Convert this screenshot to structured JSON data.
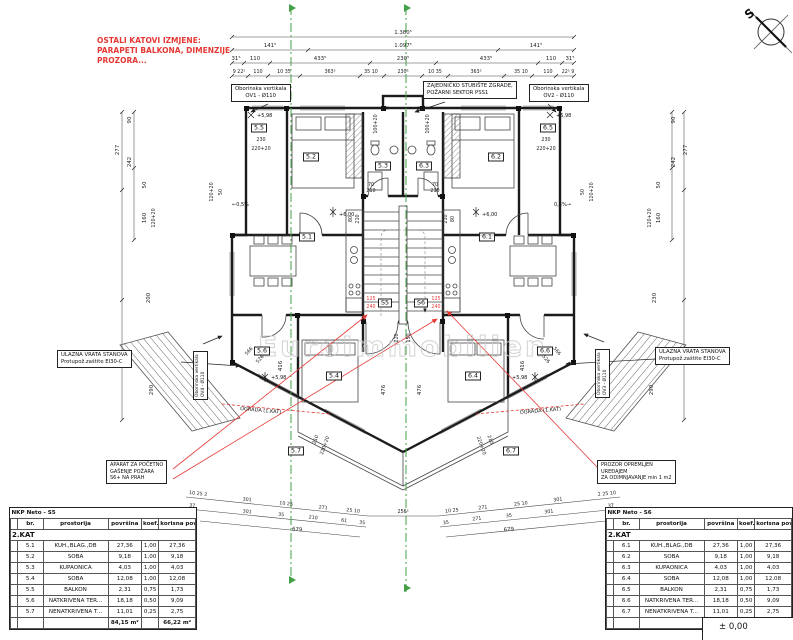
{
  "colors": {
    "wall": "#1b1b1b",
    "accent_red": "#e53935",
    "section_green": "#43a047",
    "dim_text": "#222222",
    "watermark_gray": "#c9c9c9"
  },
  "compass": {
    "label": "S"
  },
  "watermark": "EuroImmobilien",
  "notes": {
    "revision": [
      "OSTALI KATOVI IZMJENE:",
      "PARAPETI BALKONA, DIMENZIJE",
      "PROZORA..."
    ],
    "railing": "OGRADA (1.KAT)"
  },
  "callouts": {
    "ov1": [
      "Oborinska vertikala",
      "OV1 - Ø110"
    ],
    "ov2": [
      "Oborinska vertikala",
      "OV2 - Ø110"
    ],
    "ov3": [
      "Oborinska vertikala",
      "OV3 - Ø110"
    ],
    "ov4": [
      "Oborinska vertikala",
      "OV4 - Ø110"
    ],
    "stairwell": [
      "ZAJEDNIČKO STUBIŠTE ZGRADE,",
      "POŽARNI SEKTOR PSS1"
    ],
    "entry": [
      "ULAZNA VRATA STANOVA",
      "Protupož.zaštite EI30-C"
    ],
    "extinguisher": [
      "APARAT ZA POČETNO",
      "GAŠENJE POŽARA",
      "S6+ NA PRAH"
    ],
    "smoke_window": [
      "PROZOR OPREMLJEN",
      "UREĐAJEM",
      "ZA ODIMNJAVANJE min 1 m2"
    ]
  },
  "rooms": {
    "r51": "5.1",
    "r52": "5.2",
    "r53": "5.3",
    "r54": "5.4",
    "r55": "5.5",
    "r56": "5.6",
    "r57": "5.7",
    "r61": "6.1",
    "r62": "6.2",
    "r63": "6.3",
    "r64": "6.4",
    "r65": "6.5",
    "r66": "6.6",
    "r67": "6.7",
    "s5": "S5",
    "s6": "S6"
  },
  "levels": {
    "upper": "+6,00",
    "balcony": "+5,98",
    "ground": "± 0,00",
    "slope_left": "←0,5%",
    "slope_right": "0,5%→"
  },
  "dims": {
    "top1": [
      "1.380⁵"
    ],
    "top2": [
      "141⁵",
      "1.097⁵",
      "141⁵"
    ],
    "top3": [
      "31⁵",
      "110",
      "433⁵",
      "230⁵",
      "433⁵",
      "110",
      "31⁵"
    ],
    "top4": [
      "9 22⁵",
      "110",
      "10 35",
      "363⁵",
      "35 10",
      "230⁵",
      "10 35",
      "363⁵",
      "35 10",
      "110",
      "22⁵ 9"
    ],
    "left": [
      "277",
      "242",
      "90",
      "160",
      "120+20",
      "50",
      "200",
      "290"
    ],
    "right": [
      "277",
      "242",
      "90",
      "160",
      "120+20",
      "50",
      "230",
      "290"
    ],
    "side_inner": [
      "50",
      "120+20",
      "50",
      "120+20"
    ],
    "balcony_left": [
      "230",
      "220+20"
    ],
    "balcony_right": [
      "230",
      "220+20"
    ],
    "door_top": [
      "100+20",
      "100+20",
      "70",
      "210",
      "70",
      "210"
    ],
    "door_52": [
      "80",
      "210"
    ],
    "door_62": [
      "80",
      "210"
    ],
    "lower": [
      "416",
      "476",
      "476",
      "416",
      "210",
      "220+20",
      "210",
      "220+20",
      "220",
      "150"
    ],
    "diag_left": [
      "566",
      "526"
    ],
    "diag_right": [
      "566",
      "526"
    ],
    "bottomA_left": [
      "10 25 2",
      "301",
      "10 25",
      "271",
      "25 10"
    ],
    "bottomA_center": [
      "256⁵"
    ],
    "bottomA_right": [
      "10 25",
      "271",
      "25 10",
      "301",
      "2 25 10"
    ],
    "bottomB_left": [
      "37",
      "301",
      "35",
      "210",
      "61",
      "35"
    ],
    "bottomB_right": [
      "35",
      "271",
      "35",
      "301",
      "37"
    ],
    "bottomC": [
      "679",
      "679"
    ],
    "door_red_left": [
      "125",
      "240"
    ],
    "door_red_right": [
      "125",
      "240"
    ]
  },
  "tables": {
    "left": {
      "title": "NKP Neto - S5",
      "floor": "2.KAT",
      "columns": [
        "",
        "br.",
        "prostorija",
        "površina",
        "koef.",
        "korisna povr..."
      ],
      "rows": [
        [
          "",
          "5.1",
          "KUH.,BLAG.,DB",
          "27,36",
          "1,00",
          "27,36"
        ],
        [
          "",
          "5.2",
          "SOBA",
          "9,18",
          "1,00",
          "9,18"
        ],
        [
          "",
          "5.3",
          "KUPAONICA",
          "4,03",
          "1,00",
          "4,03"
        ],
        [
          "",
          "5.4",
          "SOBA",
          "12,08",
          "1,00",
          "12,08"
        ],
        [
          "",
          "5.5",
          "BALKON",
          "2,31",
          "0,75",
          "1,73"
        ],
        [
          "",
          "5.6",
          "NATKRIVENA TER...",
          "18,18",
          "0,50",
          "9,09"
        ],
        [
          "",
          "5.7",
          "NENATKRIVENA T...",
          "11,01",
          "0,25",
          "2,75"
        ]
      ],
      "total": [
        "",
        "",
        "",
        "84,15 m²",
        "",
        "66,22 m²"
      ]
    },
    "right": {
      "title": "NKP Neto - S6",
      "floor": "2.KAT",
      "columns": [
        "",
        "br.",
        "prostorija",
        "površina",
        "koef.",
        "korisna povr..."
      ],
      "rows": [
        [
          "",
          "6.1",
          "KUH.,BLAG.,DB",
          "27,36",
          "1,00",
          "27,36"
        ],
        [
          "",
          "6.2",
          "SOBA",
          "9,18",
          "1,00",
          "9,18"
        ],
        [
          "",
          "6.3",
          "KUPAONICA",
          "4,03",
          "1,00",
          "4,03"
        ],
        [
          "",
          "6.4",
          "SOBA",
          "12,08",
          "1,00",
          "12,08"
        ],
        [
          "",
          "6.5",
          "BALKON",
          "2,31",
          "0,75",
          "1,73"
        ],
        [
          "",
          "6.6",
          "NATKRIVENA TER...",
          "18,18",
          "0,50",
          "9,09"
        ],
        [
          "",
          "6.7",
          "NENATKRIVENA T...",
          "11,01",
          "0,25",
          "2,75"
        ]
      ],
      "total": [
        "",
        "",
        "",
        "84,15 m²",
        "",
        "66,22 m²"
      ]
    }
  }
}
